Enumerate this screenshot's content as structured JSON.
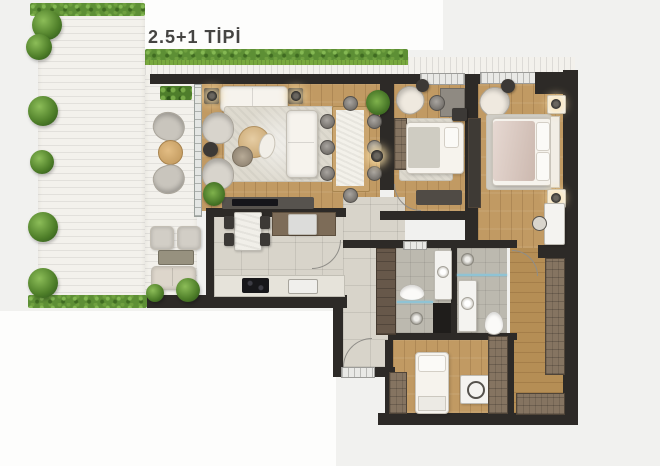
{
  "title": "2.5+1 TİPİ",
  "palette": {
    "bg": "#f1f1ef",
    "bg-white": "#fdfdfc",
    "wall": "#2d2a27",
    "wood": "#c19a63",
    "wood2": "#b58e55",
    "tile": "#d8d4ca",
    "bathtile": "#bcb9af",
    "deck": "#f3f1ec",
    "hedge": "#5d8f35",
    "grass": "#79a93e",
    "glass": "#8fc3d4",
    "white-furn": "#f6f3ed",
    "gray-furn": "#b7b3ab",
    "dark-furn": "#3c3936",
    "brown-cab": "#67584a",
    "wardrobe": "#857461",
    "rug": "#dedacf",
    "title-color": "#454442"
  }
}
